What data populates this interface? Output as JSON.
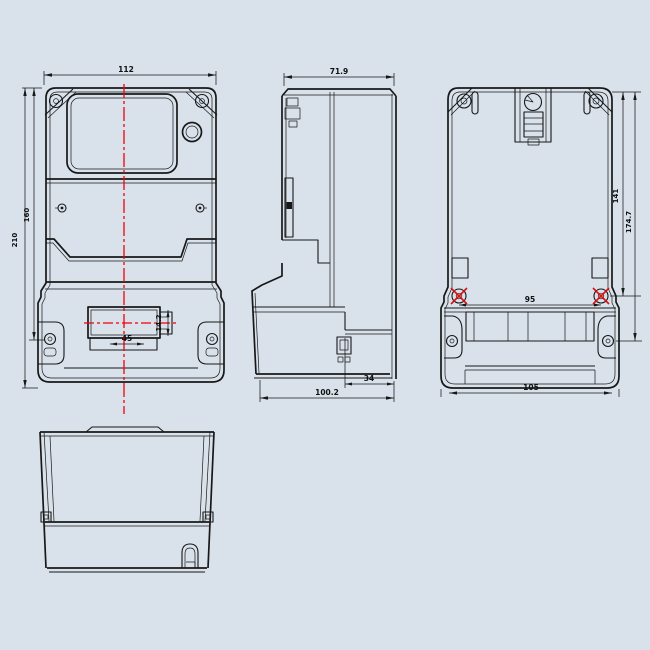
{
  "drawing": {
    "background_color": "#d9e2eb",
    "line_color": "#181818",
    "centerline_color": "#f2000a",
    "views": {
      "front": {
        "dims": {
          "width": "112",
          "height_outer": "210",
          "height_inner": "160",
          "recess_width": "45",
          "recess_height": "14.2"
        }
      },
      "side": {
        "dims": {
          "depth_body": "71.9",
          "depth_total": "100.2",
          "depth_cover": "34"
        }
      },
      "rear": {
        "dims": {
          "mount_height_upper": "141",
          "mount_height_full": "174.7",
          "mount_width": "95",
          "width_bottom": "105"
        }
      }
    }
  }
}
